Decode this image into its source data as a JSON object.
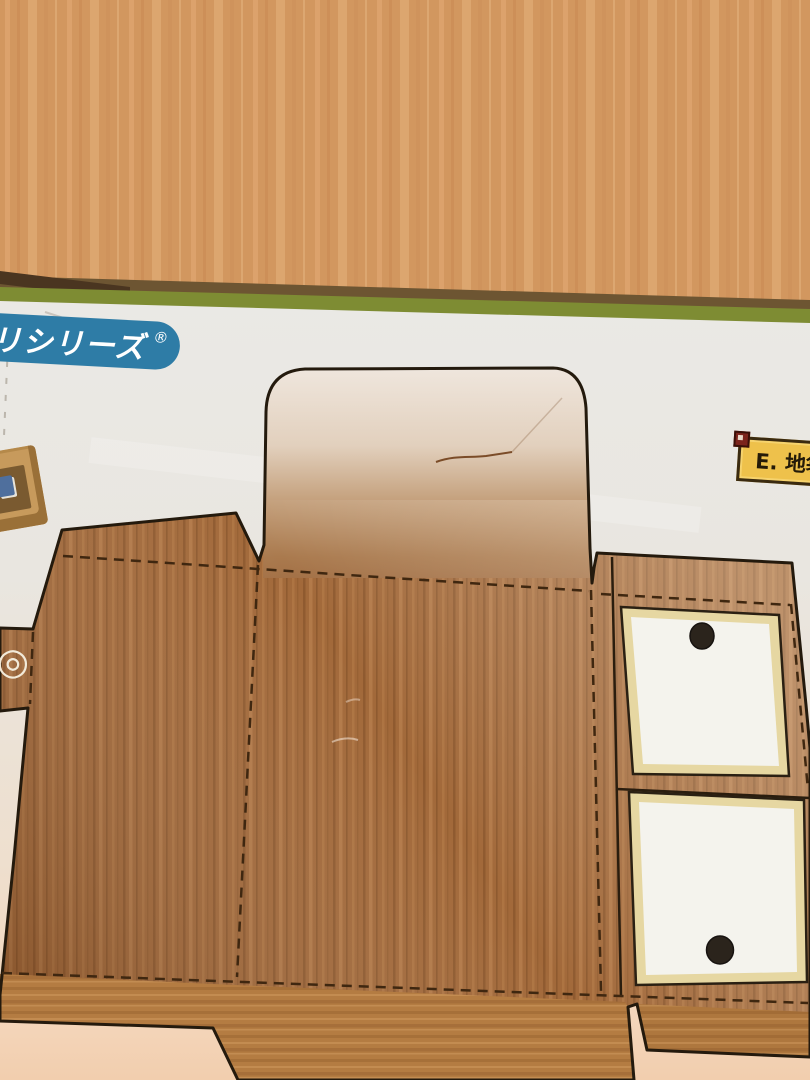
{
  "photo": {
    "subject": "die-cut wood-grain papercraft sheet on a wooden table"
  },
  "labels": {
    "series_badge": {
      "text": "リシリーズ",
      "registered_mark": "®",
      "bg": "#2e7ca6",
      "fg": "#ffffff"
    },
    "part_label": {
      "text": "E. 地袋",
      "bg": "#eec14b",
      "border": "#3a2a10",
      "corner_square": "#7c241c",
      "fg": "#241a08"
    },
    "registration_mark": {
      "glyph": "◎",
      "color": "#f2ead9"
    }
  },
  "palette": {
    "table_wood": "#d09156",
    "edge_strip_green": "#7e8c33",
    "edge_shadow": "#6d5532",
    "sheet_white": "#eae9e5",
    "sheet_warm_pink": "#f4d8be",
    "panel_wood": "#a2693a",
    "bottom_flap_wood": "#b47c42",
    "flap_glare": "#efe6dd",
    "shoji_border_cream": "#e6d7a2",
    "shoji_paper": "#f4f3ed",
    "finger_hole": "#2b241c",
    "die_outline": "#241a0d",
    "fold_dash": "#3f2710"
  }
}
